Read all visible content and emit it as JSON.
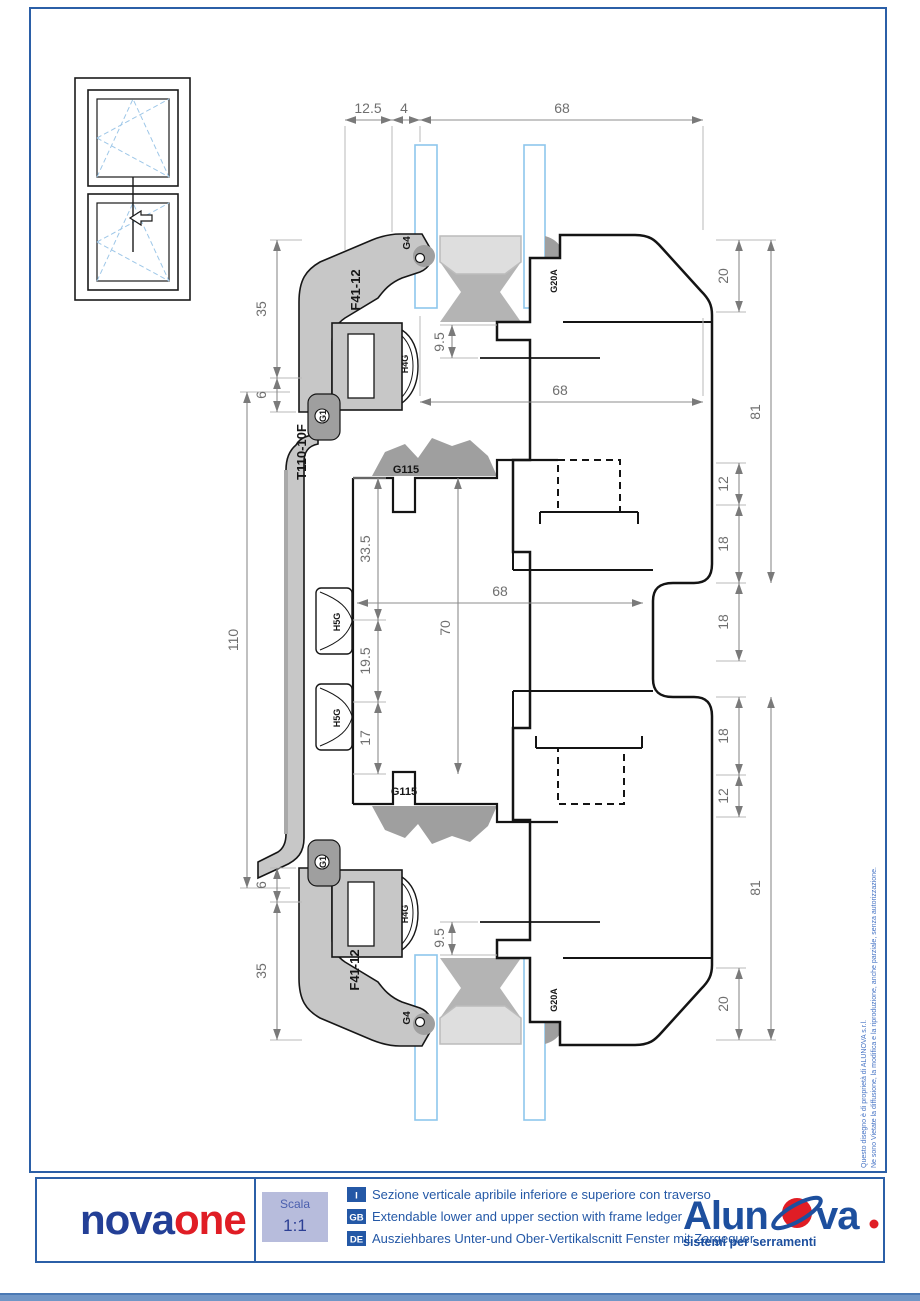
{
  "dims": {
    "top": {
      "d12_5": "12.5",
      "d4": "4",
      "d68": "68"
    },
    "left": {
      "d35_top": "35",
      "d6_top": "6",
      "d110": "110",
      "d6_bot": "6",
      "d35_bot": "35"
    },
    "center": {
      "d9_5_top": "9.5",
      "d68_upper": "68",
      "d33_5": "33.5",
      "d70": "70",
      "d68_mid": "68",
      "d19_5": "19.5",
      "d17": "17",
      "d9_5_bot": "9.5"
    },
    "right": {
      "d20_top": "20",
      "d81_top": "81",
      "d12_top": "12",
      "d18_a": "18",
      "d18_b": "18",
      "d18_c": "18",
      "d12_bot": "12",
      "d81_bot": "81",
      "d20_bot": "20"
    }
  },
  "labels": {
    "g4_top": "G4",
    "f4112_top": "F41-12",
    "h4g_top": "H4G",
    "g20a_top": "G20A",
    "g1_top": "G1",
    "t110": "T110-10F",
    "g115_top": "G115",
    "h5g_1": "H5G",
    "h5g_2": "H5G",
    "g115_bot": "G115",
    "g1_bot": "G1",
    "h4g_bot": "H4G",
    "f4112_bot": "F41-12",
    "g4_bot": "G4",
    "g20a_bot": "G20A"
  },
  "copyright": {
    "line1": "Questo disegno è di proprietà di ALUNOVA s.r.l.",
    "line2": "Ne sono Vietate la diffusione, la modifica e la riproduzione, anche parziale, senza autorizzazione."
  },
  "title_block": {
    "brand": {
      "part1": "nova",
      "part2": "one"
    },
    "scale": {
      "label": "Scala",
      "value": "1:1"
    },
    "descriptions": [
      {
        "lang": "I",
        "text": "Sezione verticale apribile inferiore e superiore con traverso"
      },
      {
        "lang": "GB",
        "text": "Extendable lower and upper section with frame ledger"
      },
      {
        "lang": "DE",
        "text": "Ausziehbares Unter-und Ober-Vertikalscnitt Fenster mit Zargequer"
      }
    ],
    "logo": {
      "part1": "Alun",
      "part2": "va",
      "tagline": "sistemi per serramenti"
    }
  },
  "colors": {
    "border_blue": "#2b5fa7",
    "brand_blue": "#233f96",
    "brand_red": "#e01d25",
    "alunova_blue": "#1d4f9e",
    "scala_bg": "#b7bcdc"
  }
}
